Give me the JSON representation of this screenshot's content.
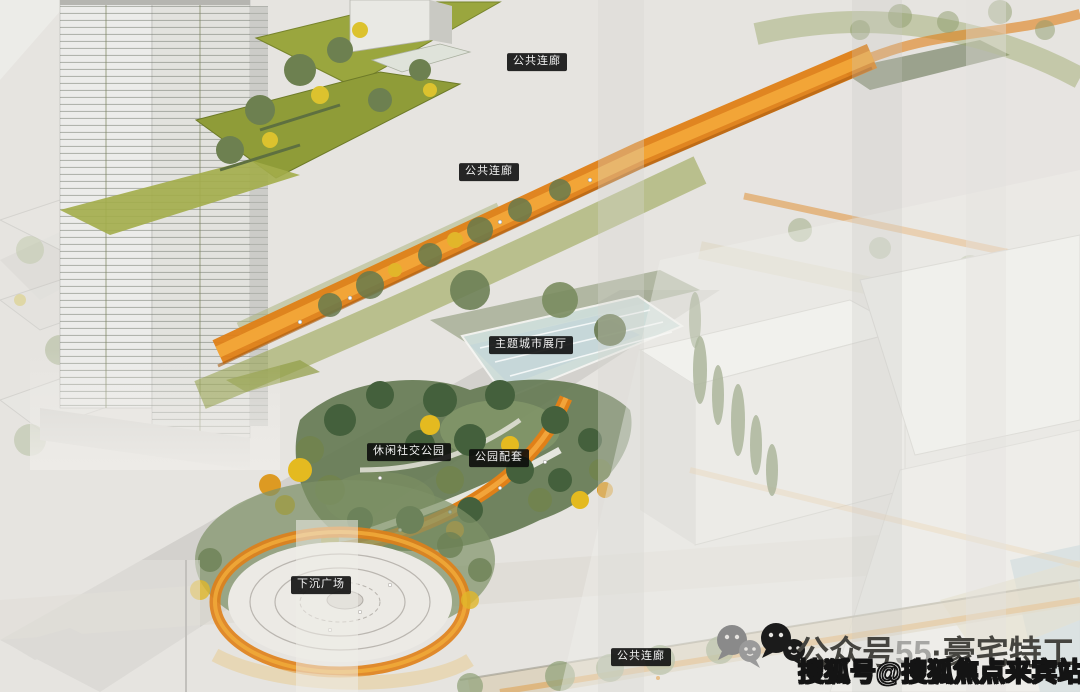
{
  "labels": [
    {
      "text": "公共连廊"
    },
    {
      "text": "公共连廊"
    },
    {
      "text": "主题城市展厅"
    },
    {
      "text": "休闲社交公园"
    },
    {
      "text": "公园配套"
    },
    {
      "text": "下沉广场"
    },
    {
      "text": "公共连廊"
    }
  ],
  "footer": {
    "account_prefix": "公众号",
    "ghost_digits": "55",
    "account_suffix": "·豪宅特工",
    "watermark": "搜狐号@搜狐焦点来宾站"
  },
  "colors": {
    "corridor_orange": "#df7f16",
    "corridor_orange_light": "#f4a83a",
    "roof_green": "#94a03c",
    "park_green": "#637851",
    "tree_dark_green": "#44603c",
    "tree_yellow": "#e4ba20",
    "pond_blue": "#cfdeda",
    "building_white": "#f2f1ee",
    "label_bg": "#0d0d0d",
    "label_text": "#f2f2f2",
    "title_gray": "#45443f",
    "watermark_white": "#ffffff"
  }
}
